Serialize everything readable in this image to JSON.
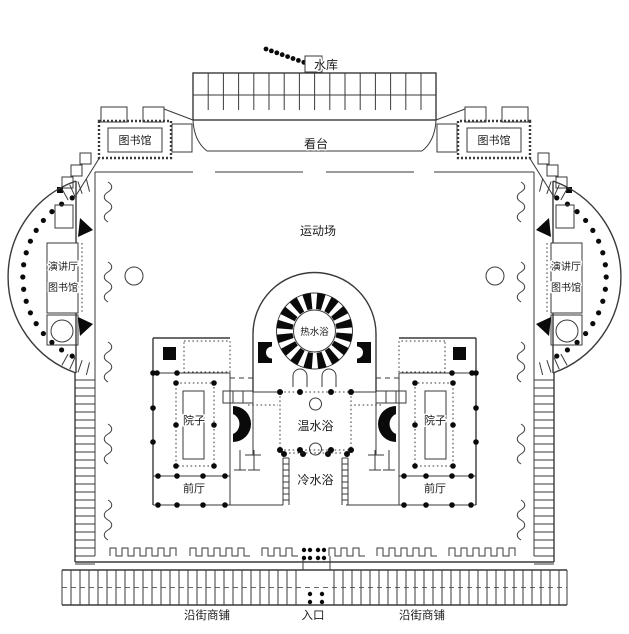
{
  "diagram": {
    "labels": {
      "reservoir": "水库",
      "grandstand": "看台",
      "sports_field": "运动场",
      "library_left": "图书馆",
      "library_right": "图书馆",
      "exedra_left_line1": "演讲厅",
      "exedra_left_line2": "图书馆",
      "exedra_right_line1": "演讲厅",
      "exedra_right_line2": "图书馆",
      "hot_bath": "热水浴",
      "warm_bath": "温水浴",
      "cold_bath": "冷水浴",
      "courtyard_left": "院子",
      "courtyard_right": "院子",
      "front_hall_left": "前厅",
      "front_hall_right": "前厅",
      "shops_left": "沿街商铺",
      "shops_right": "沿街商铺",
      "entrance": "入口"
    },
    "colors": {
      "line": "#3a3a3a",
      "ink": "#0a0a0a",
      "background": "#ffffff"
    }
  }
}
